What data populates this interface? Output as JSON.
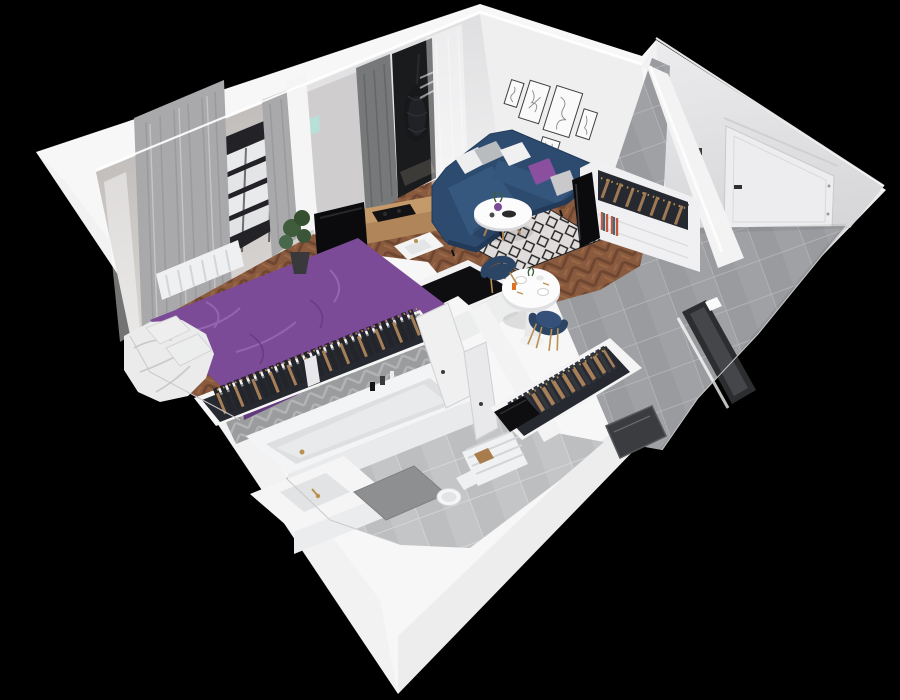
{
  "scene": {
    "kind": "3D isometric cutaway render of a one-bedroom apartment floor plan",
    "background": "#000000",
    "rooms": [
      {
        "id": "bedroom",
        "label": "Bedroom",
        "items": [
          "double bed with purple bedding",
          "white duvet and pillows",
          "long gray curtains",
          "window with white blinds",
          "white radiator",
          "potted plant",
          "built-in wardrobe with hanging clothes",
          "wood floor"
        ]
      },
      {
        "id": "living-room",
        "label": "Living room",
        "items": [
          "navy corner sofa",
          "white, gray and purple cushions",
          "round white coffee table with purple vase",
          "black and white diamond rug",
          "gallery wall with five framed line-art prints",
          "balcony doorway with hanging egg chair",
          "gray curtain and white sheer",
          "herringbone wood floor",
          "small teal wall picture"
        ]
      },
      {
        "id": "kitchen-dining",
        "label": "Kitchen / dining",
        "items": [
          "wood counter with black cooktop",
          "wall-mounted TV on half wall",
          "white sink with gold tap",
          "white island with black top",
          "round white dining table with plates and orange juice",
          "two navy chairs with gold legs"
        ]
      },
      {
        "id": "hallway",
        "label": "Entrance hall",
        "items": [
          "white entrance door with dark handle",
          "open wardrobe with clothes rail and shelf of books",
          "leaning TV panel",
          "second open wardrobe with clothes rail",
          "black cabinet top",
          "gray tile floor",
          "dark framed window in side wall",
          "dark glass panel"
        ]
      },
      {
        "id": "bathroom",
        "label": "Bathroom",
        "items": [
          "white bathtub with gold tap",
          "gray herringbone tile wall",
          "vanity counter with gold faucet",
          "toilet",
          "white towel radiator",
          "gray bath mat",
          "wooden stool",
          "toiletry bottles",
          "two white doors ajar"
        ]
      }
    ]
  },
  "colors": {
    "background": "#000000",
    "wall_white": "#f7f7f8",
    "wall_inner_warm": "#c9c5c2",
    "wall_inner_light": "#e7e7e9",
    "gallery_wall": "#efeff0",
    "entry_wall": "#e4e4e6",
    "divider_gray": "#cfcdce",
    "wood_floor": "#8a5a3e",
    "wood_dark": "#6f4630",
    "wood_light": "#9c6b49",
    "tile_floor": "#9fa1a4",
    "tile_grout": "#b7b9bb",
    "bath_tile": "#c3c5c7",
    "rug_base": "#e4e4e4",
    "rug_diamond": "#1d1d1f",
    "sofa": "#2d4b6f",
    "sofa_dark": "#223a58",
    "sofa_light": "#3a5c85",
    "bed": "#7b4b97",
    "bed_dark": "#63397e",
    "bed_light": "#9a6cb5",
    "pillow": "#eeeeef",
    "cushion_purple": "#8b4fa0",
    "curtain": "#a9a9ab",
    "curtain_dark": "#77787a",
    "window_dark": "#232327",
    "door": "#ededef",
    "tv": "#0b0b0d",
    "counter_wood": "#c59a6b",
    "black_top": "#0e0e10",
    "clothes_dark": "#272930",
    "clothes_tan": "#b4885c",
    "gold": "#b8914f",
    "plant": "#3f5c3c",
    "chair_navy": "#2c4565",
    "table_white": "#fcfcfd",
    "herringbone_wall": "#9b9c9e",
    "glass_dark": "#3a3c3f",
    "teal": "#b9e0d8",
    "balcony_chair": "#17181a",
    "orange": "#e07020"
  }
}
